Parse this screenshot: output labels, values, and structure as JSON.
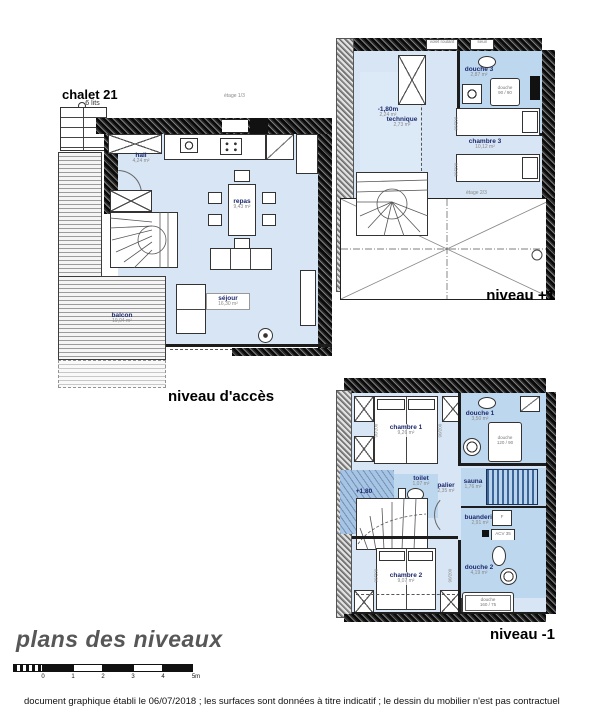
{
  "header": {
    "title": "chalet 21",
    "beds": "6 lits"
  },
  "notes": {
    "etage_acces": "étage 1/3",
    "etage_plus1": "étage 2/3",
    "volet": "volet roulant",
    "seuil": "seuil"
  },
  "fixtures": {
    "shower_word": "douche",
    "shower_90": "90 / 90",
    "shower_120": "120 / 90",
    "shower_160": "160 / 75",
    "freezer": "F",
    "heater": "ACV 35",
    "bed_size": "90/200"
  },
  "plans": {
    "acces": {
      "title": "niveau d'accès",
      "rooms": {
        "hall": {
          "name": "hall",
          "area": "4,24 m²"
        },
        "repas": {
          "name": "repas",
          "area": "9,43 m²"
        },
        "sejour": {
          "name": "séjour",
          "area": "16,30 m²"
        },
        "balcon": {
          "name": "balcon",
          "area": "19,04 m²"
        }
      }
    },
    "plus1": {
      "title": "niveau +1",
      "rooms": {
        "low": {
          "name": "-1,80m",
          "area": "2,24 m²"
        },
        "technique": {
          "name": "technique",
          "area": "2,73 m²"
        },
        "douche3": {
          "name": "douche 3",
          "area": "2,87 m²"
        },
        "chambre3": {
          "name": "chambre 3",
          "area": "10,12 m²"
        }
      }
    },
    "minus1": {
      "title": "niveau -1",
      "rooms": {
        "chambre1": {
          "name": "chambre 1",
          "area": "9,26 m²"
        },
        "douche1": {
          "name": "douche 1",
          "area": "3,50 m²"
        },
        "sauna": {
          "name": "sauna",
          "area": "1,76 m²"
        },
        "buanderie": {
          "name": "buanderie",
          "area": "2,91 m²"
        },
        "toilet": {
          "name": "toilet",
          "area": "1,07 m²"
        },
        "palier": {
          "name": "palier",
          "area": "2,35 m²"
        },
        "low": {
          "name": "+1,80"
        },
        "chambre2": {
          "name": "chambre 2",
          "area": "9,07 m²"
        },
        "douche2": {
          "name": "douche 2",
          "area": "4,19 m²"
        }
      }
    }
  },
  "footer": {
    "title": "plans des niveaux",
    "scale_ticks": [
      "0",
      "1",
      "2",
      "3",
      "4",
      "5m"
    ],
    "note": "document graphique établi le 06/07/2018 ; les surfaces sont données à titre indicatif ; le dessin du mobilier n'est pas contractuel"
  }
}
